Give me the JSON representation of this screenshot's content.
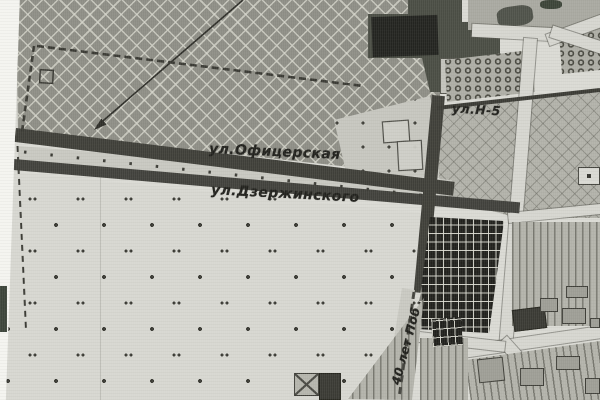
{
  "map": {
    "streets": [
      {
        "id": "ofitserskaya",
        "label": "ул.Офицерская"
      },
      {
        "id": "dzerzhinskogo",
        "label": "ул.Дзержинского"
      },
      {
        "id": "n5",
        "label": "ул.Н-5"
      },
      {
        "id": "pobedy",
        "label": "40 лет Поб"
      }
    ],
    "colors": {
      "paper": "#dadad4",
      "crosshatch_field": "#8e8e86",
      "dark_road": "#3f3f39",
      "light_road": "#d6d6d0",
      "dark_parcel": "#4a4d44",
      "black_building": "#232420",
      "cemetery_block": "#21211d",
      "dotted_field": "#d7d7d1",
      "label_ink": "#21211d"
    },
    "regions": [
      "crosshatch-field",
      "orchard-rows",
      "parcel-hatch",
      "dotted-meadow",
      "cemetery-grid",
      "urban-blocks"
    ]
  }
}
